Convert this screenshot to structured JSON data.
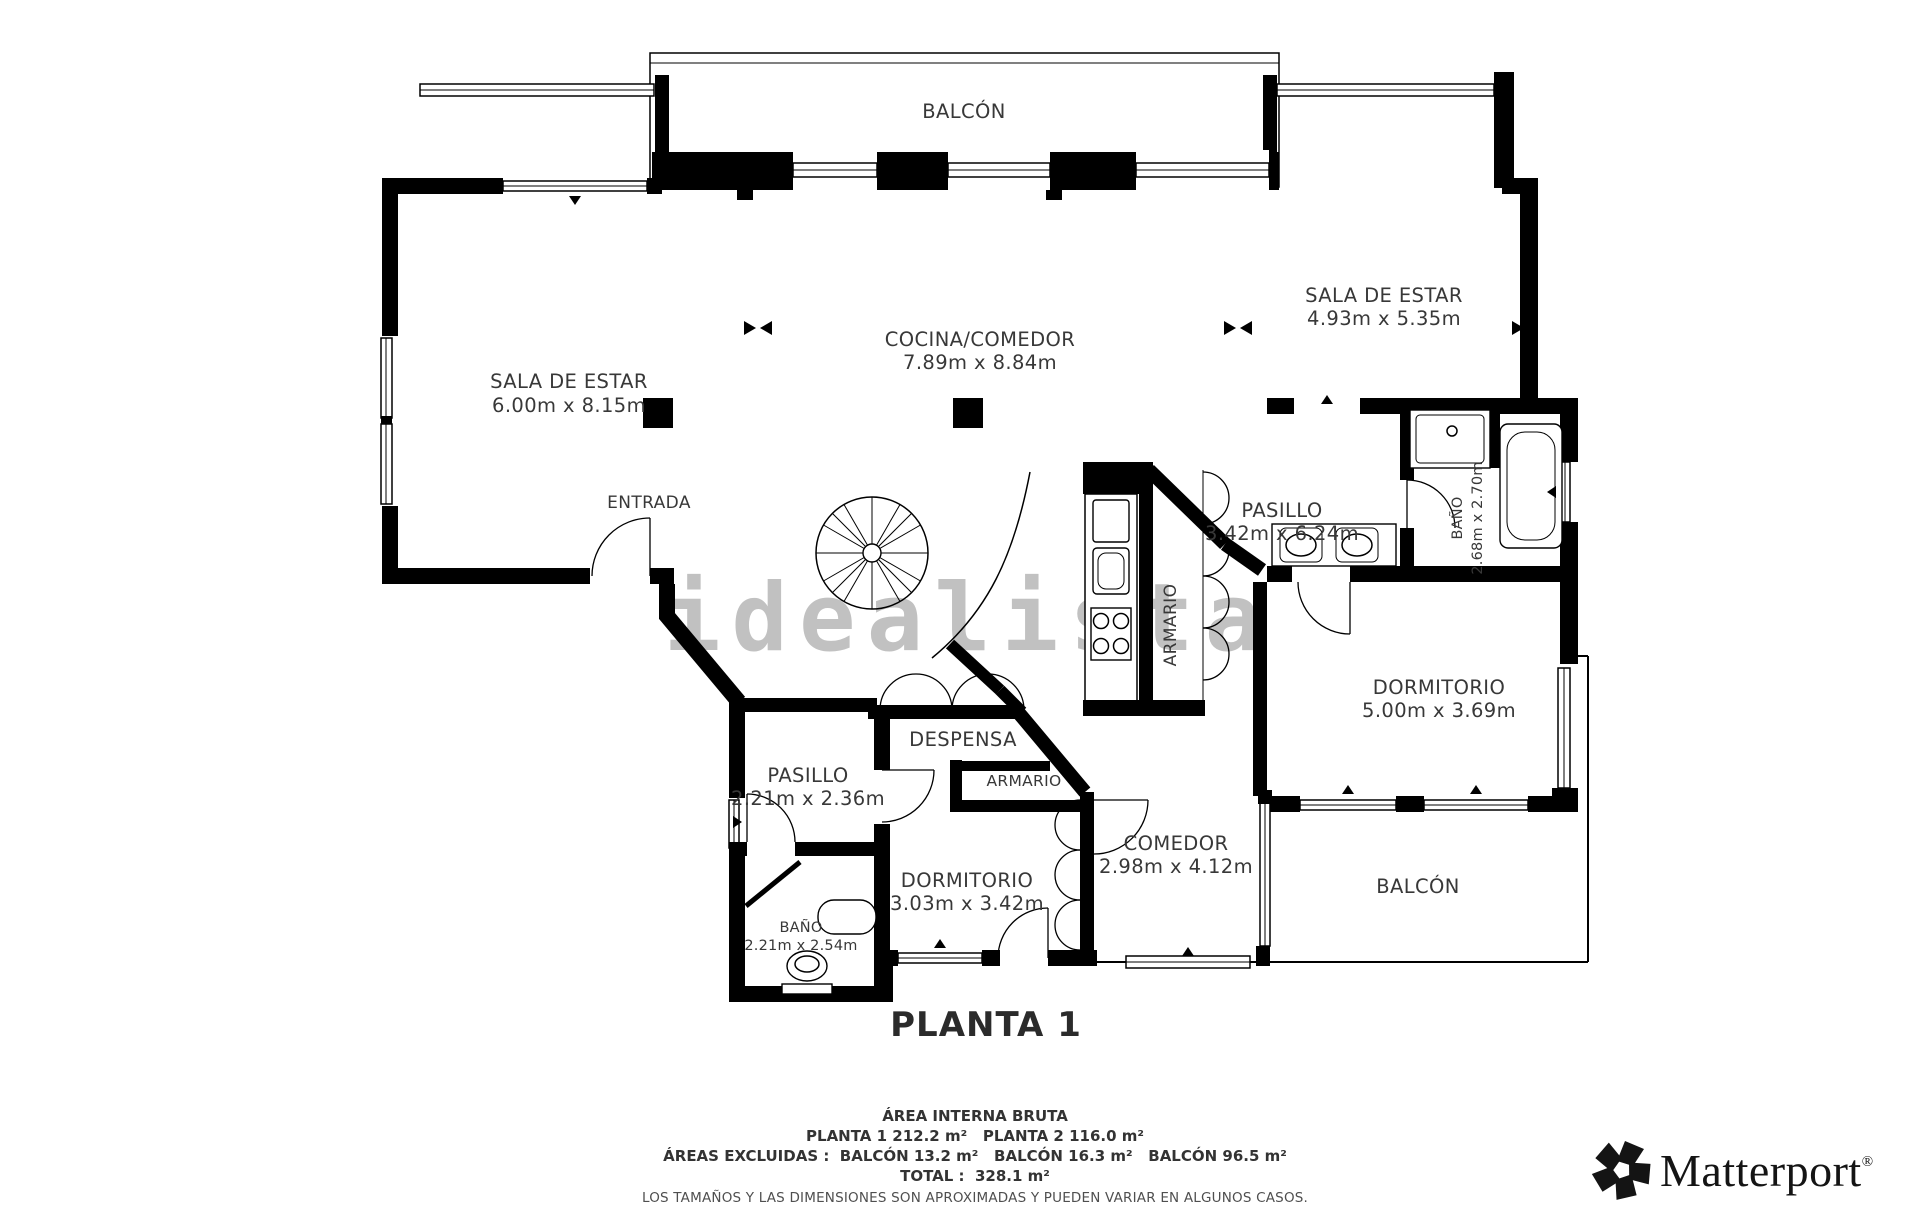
{
  "plan": {
    "floor_title": "PLANTA 1",
    "watermark": "idealista",
    "rooms": {
      "balcon_top": {
        "name": "BALCÓN"
      },
      "sala_left": {
        "name": "SALA DE ESTAR",
        "dims": "6.00m x 8.15m"
      },
      "cocina_comedor": {
        "name": "COCINA/COMEDOR",
        "dims": "7.89m x 8.84m"
      },
      "sala_right": {
        "name": "SALA DE ESTAR",
        "dims": "4.93m x 5.35m"
      },
      "entrada": {
        "name": "ENTRADA"
      },
      "pasillo_right": {
        "name": "PASILLO",
        "dims": "3.42m x 6.24m"
      },
      "bano_right": {
        "name": "BAÑO",
        "dims": "2.68m x 2.70m"
      },
      "dormitorio_right": {
        "name": "DORMITORIO",
        "dims": "5.00m x 3.69m"
      },
      "armario_core": {
        "name": "ARMARIO"
      },
      "despensa": {
        "name": "DESPENSA"
      },
      "armario_small": {
        "name": "ARMARIO"
      },
      "pasillo_left": {
        "name": "PASILLO",
        "dims": "2.21m x 2.36m"
      },
      "bano_left": {
        "name": "BAÑO",
        "dims": "2.21m x 2.54m"
      },
      "dormitorio_left": {
        "name": "DORMITORIO",
        "dims": "3.03m x 3.42m"
      },
      "comedor": {
        "name": "COMEDOR",
        "dims": "2.98m x 4.12m"
      },
      "balcon_bottom": {
        "name": "BALCÓN"
      }
    }
  },
  "summary": {
    "title": "ÁREA INTERNA BRUTA",
    "line1": "PLANTA 1 212.2 m²   PLANTA 2 116.0 m²",
    "line2": "ÁREAS EXCLUIDAS :  BALCÓN 13.2 m²   BALCÓN 16.3 m²   BALCÓN 96.5 m²",
    "line3": "TOTAL :  328.1 m²",
    "disclaimer": "LOS TAMAÑOS Y LAS DIMENSIONES SON APROXIMADAS Y PUEDEN VARIAR EN ALGUNOS CASOS."
  },
  "brand": {
    "name": "Matterport",
    "registered": "®"
  },
  "colors": {
    "wall": "#000000",
    "label_text": "#383838",
    "watermark": "#b0b0b0",
    "background": "#ffffff"
  }
}
